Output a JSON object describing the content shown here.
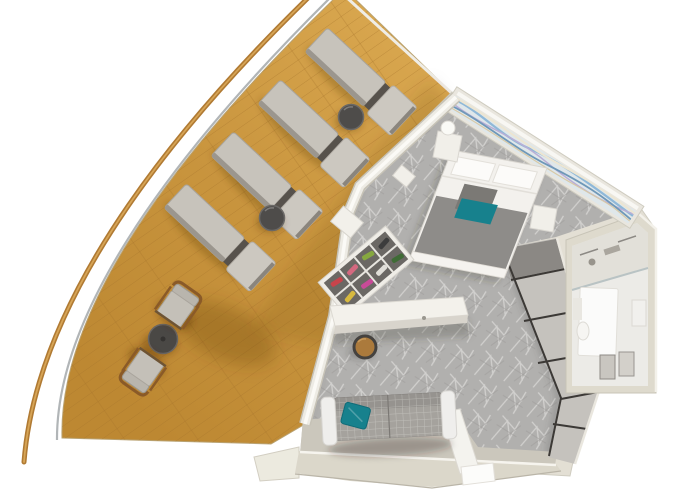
{
  "meta": {
    "title": "Cruise ship suite 3D floor plan",
    "description": "Top-down 3D rendering of a suite with a wraparound teak balcony, bedroom, living area, entry and bathroom"
  },
  "palette": {
    "background": "#ffffff",
    "deck_wood": "#c9953e",
    "deck_wood_light": "#d9a74f",
    "deck_wood_dark": "#bd8832",
    "plank_line": "#a5742c",
    "railing_wood": "#b07a33",
    "railing_highlight": "#d7a556",
    "glass_edge": "#a8adaf",
    "wall": "#e3dfd4",
    "wall_edge_white": "#f8f7f3",
    "carpet": "#b1b0ae",
    "carpet_line": "#d9d8d6",
    "closet_panel": "#c5c2bd",
    "closet_trim": "#3c3936",
    "lounger_cushion": "#c7c3bb",
    "accent_teal": "#17818d",
    "bed_linen": "#f3f1ed",
    "blanket_gray": "#8e8c89",
    "bathroom_floor": "#ecebe7",
    "side_table": "#4e4c4a",
    "stool_wood": "#ab7a3c",
    "entry_floor": "#cbc7bc",
    "shoe_colors": [
      "#c8444b",
      "#d4687f",
      "#3f6b35",
      "#86a83f",
      "#d7b93f",
      "#3c3c3c",
      "#c84b98",
      "#e0ded8"
    ]
  },
  "scene": {
    "balcony": {
      "label": "Wraparound teak balcony with sun loungers and bistro set",
      "loungers": [
        {
          "x": 359,
          "y": 79,
          "rot": 43
        },
        {
          "x": 312,
          "y": 131,
          "rot": 43
        },
        {
          "x": 265,
          "y": 183,
          "rot": 43
        },
        {
          "x": 218,
          "y": 235,
          "rot": 43
        }
      ],
      "side_tables": [
        {
          "x": 351,
          "y": 117
        },
        {
          "x": 272,
          "y": 218
        }
      ],
      "bistro": {
        "table": {
          "x": 163,
          "y": 339
        },
        "chairs": [
          {
            "x": 178,
            "y": 306,
            "rot": 35
          },
          {
            "x": 143,
            "y": 371,
            "rot": 215
          }
        ]
      }
    },
    "bedroom": {
      "label": "Bedroom with double bed, nightstands and wave-art headboard wall"
    },
    "living": {
      "label": "Living area with sofa, desk, stool, shoe rack and wardrobe"
    },
    "bathroom": {
      "label": "Bathroom with shower, vanity and toilet"
    },
    "entry": {
      "label": "Entry hallway with threshold step"
    }
  }
}
